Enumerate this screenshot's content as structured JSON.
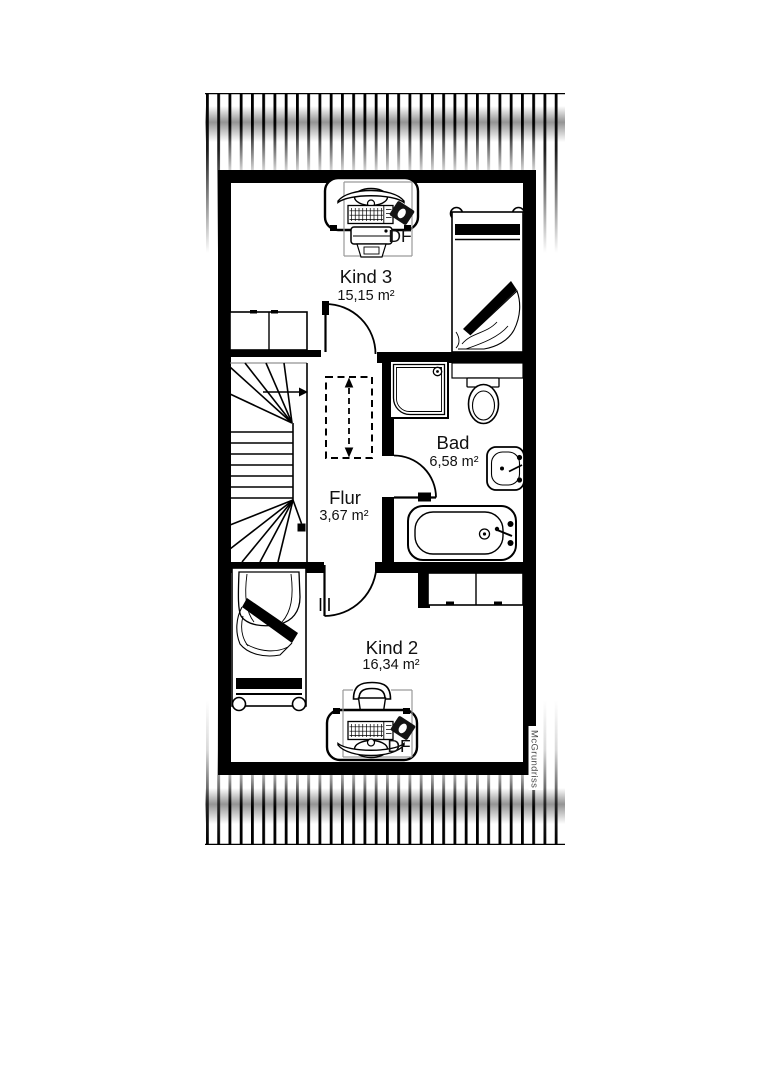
{
  "document": {
    "watermark": "McGrundriss"
  },
  "rooms": [
    {
      "name": "Kind 3",
      "area": "15,15 m²"
    },
    {
      "name": "Bad",
      "area": "6,58 m²"
    },
    {
      "name": "Flur",
      "area": "3,67 m²"
    },
    {
      "name": "Kind 2",
      "area": "16,34 m²"
    }
  ],
  "skylights": [
    {
      "label": "DF"
    },
    {
      "label": "DF"
    }
  ],
  "stairs": {
    "direction_arrow": "right"
  },
  "colors": {
    "wall": "#000000",
    "line": "#111111",
    "muted_line": "#9a9a9a",
    "watermark_text": "#4a4a4a",
    "background": "#ffffff"
  }
}
